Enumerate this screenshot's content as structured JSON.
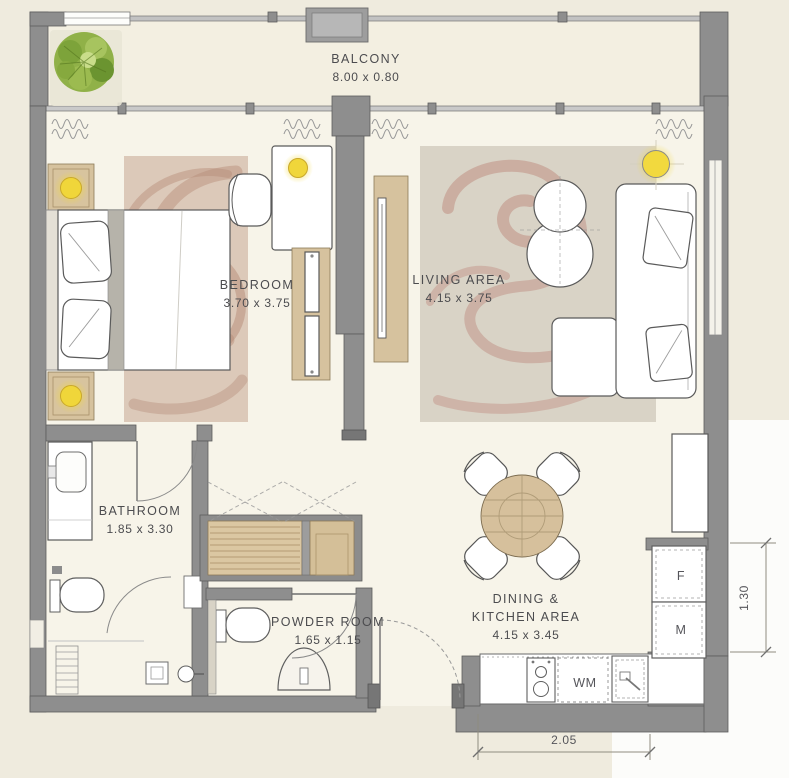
{
  "floor_plan": {
    "balcony": {
      "label": "BALCONY",
      "size": "8.00 x 0.80"
    },
    "bedroom": {
      "label": "BEDROOM",
      "size": "3.70 x 3.75"
    },
    "living_area": {
      "label": "LIVING AREA",
      "size": "4.15 x 3.75"
    },
    "bathroom": {
      "label": "BATHROOM",
      "size": "1.85 x 3.30"
    },
    "powder_room": {
      "label": "POWDER ROOM",
      "size": "1.65 x 1.15"
    },
    "dining_kitchen": {
      "label_line1": "DINING &",
      "label_line2": "KITCHEN AREA",
      "size": "4.15 x 3.45"
    },
    "appliance_labels": {
      "f": "F",
      "m": "M",
      "wm": "WM"
    },
    "dimension_labels": {
      "right_side": "1.30",
      "bottom": "2.05"
    },
    "colors": {
      "wall": "#8e8e8e",
      "background": "#efebde",
      "floor": "#f7f4e9",
      "lamp_accent": "#f0d63a",
      "rug_swirl": "#c0948a",
      "wood": "#d6c29e",
      "plant_green": "#86a93e",
      "label_text": "#4c4c4f"
    }
  }
}
